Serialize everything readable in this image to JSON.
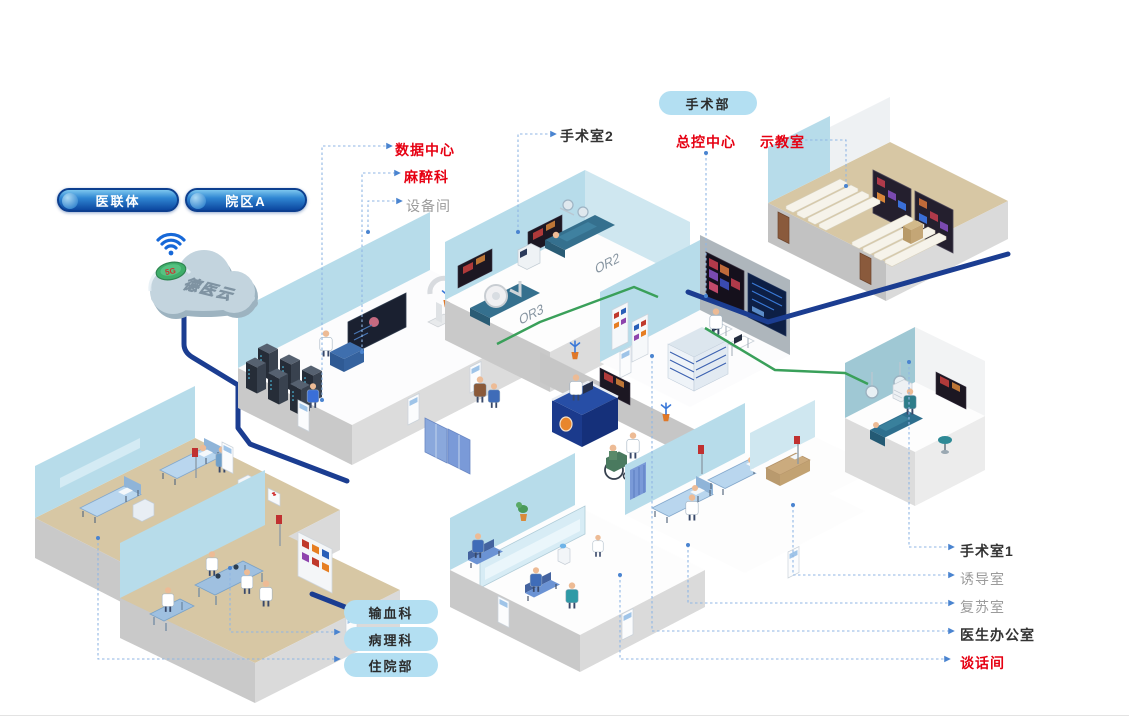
{
  "header": {
    "dept_pill": "手术部"
  },
  "org_pills": {
    "consortium": "医联体",
    "campus": "院区A"
  },
  "cloud": {
    "name": "德医云",
    "badge": "5G",
    "icon": "wifi-icon"
  },
  "room_labels": {
    "data_center": "数据中心",
    "anesthesia": "麻醉科",
    "equipment_room": "设备间",
    "operating_room_2": "手术室2",
    "master_control": "总控中心",
    "demo_classroom": "示教室",
    "operating_room_1": "手术室1",
    "induction_room": "诱导室",
    "recovery_room": "复苏室",
    "doctor_office": "医生办公室",
    "talk_room": "谈话间"
  },
  "dept_pills": {
    "blood_transfusion": "输血科",
    "pathology": "病理科",
    "inpatient": "住院部"
  },
  "wall_texts": {
    "or2": "OR2",
    "or3": "OR3"
  },
  "colors": {
    "label_red": "#e60012",
    "label_dark": "#333333",
    "label_gray": "#9b9b9b",
    "pill_light_blue": "#b3dff2",
    "pill_dark_blue_top": "#58b0e4",
    "pill_dark_blue_bottom": "#0b47a0",
    "cable_blue": "#1b3d91",
    "cable_green": "#3aa05a",
    "leader_blue": "#8fb6e4",
    "wall_blue": "#b7dcea",
    "floor_tan": "#d7c7a4"
  }
}
